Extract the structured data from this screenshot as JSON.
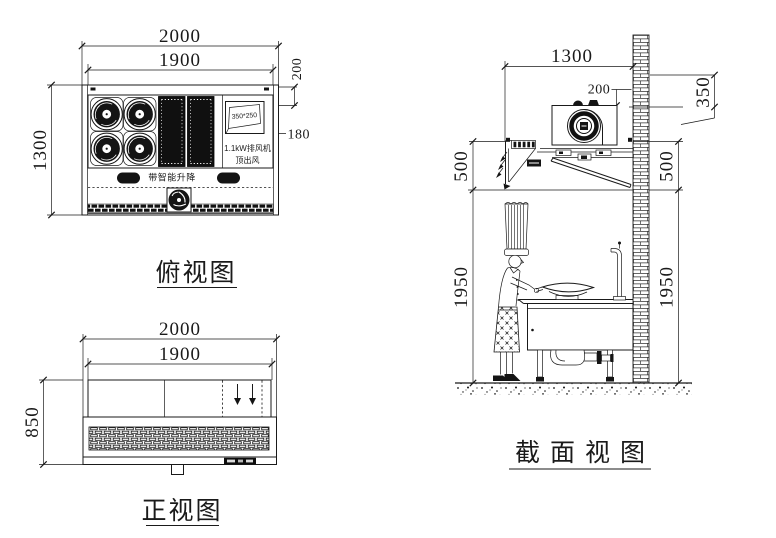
{
  "top_view": {
    "title": "俯视图",
    "dims": {
      "width_overall": "2000",
      "width_inner": "1900",
      "depth": "1300",
      "offset_back": "200",
      "offset_duct": "180"
    },
    "labels": {
      "duct_size": "350*250",
      "fan_power": "1.1kW排风机",
      "fan_outlet": "顶出风",
      "lift": "带智能升降"
    }
  },
  "front_view": {
    "title": "正视图",
    "dims": {
      "width_overall": "2000",
      "width_inner": "1900",
      "height": "850"
    }
  },
  "section_view": {
    "title": "截面视图",
    "dims": {
      "depth": "1300",
      "duct_offset": "200",
      "wall_out": "350",
      "hood_left": "500",
      "hood_right": "500",
      "clearance_left": "1950",
      "clearance_right": "1950"
    }
  }
}
